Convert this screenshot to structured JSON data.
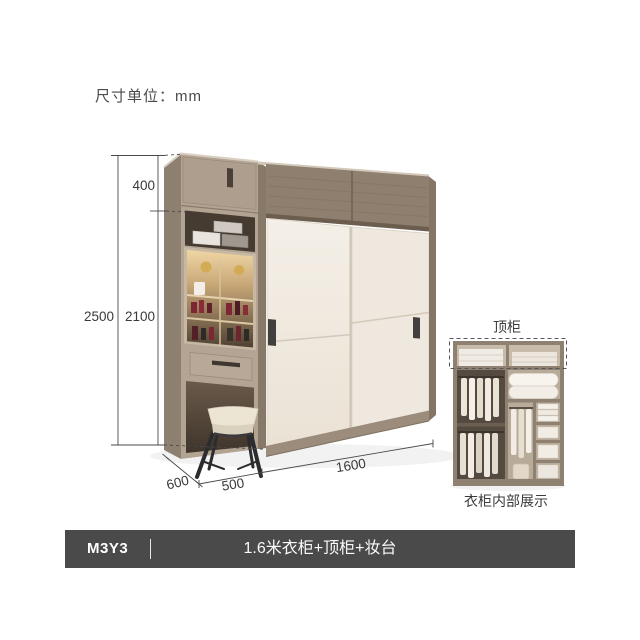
{
  "unit_note": "尺寸单位：mm",
  "dimensions": {
    "top_cabinet_height": "400",
    "total_height": "2500",
    "main_height": "2100",
    "depth": "600",
    "dresser_width": "500",
    "wardrobe_width": "1600"
  },
  "inset": {
    "top_cabinet_label": "顶柜",
    "caption": "衣柜内部展示"
  },
  "footer": {
    "model": "M3Y3",
    "title": "1.6米衣柜+顶柜+妆台"
  },
  "colors": {
    "footer_bg": "#4a4a4a",
    "footer_text": "#ffffff",
    "wood_front": "#b2a393",
    "wood_side": "#8e8071",
    "wood_top_band": "#8e7f6f",
    "sliding_door": "#f1ebe2",
    "handle": "#41403e",
    "dimension_line": "#4a4a4a",
    "label_text": "#3b3b3b",
    "background": "#ffffff"
  }
}
